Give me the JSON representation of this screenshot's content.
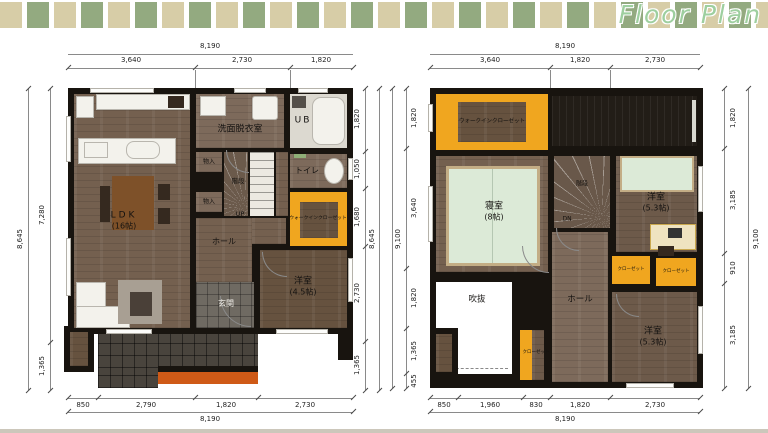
{
  "header": {
    "title": "Floor Plan"
  },
  "colors": {
    "band_beige": "#d7cda7",
    "band_green": "#93aa80",
    "title_green": "#9ecf9f",
    "wall_black": "#18140f",
    "floor_wood": "#74604f",
    "closet_orange": "#f0a61f",
    "step_orange": "#cf5a17",
    "bed_green": "#dcead7",
    "porch_tile": "#49443d"
  },
  "plan1": {
    "top": {
      "total": "8,190",
      "segments": [
        "3,640",
        "2,730",
        "1,820"
      ]
    },
    "left": {
      "total": "8,645",
      "segments": [
        "7,280",
        "1,365"
      ]
    },
    "right": {
      "total": "8,645",
      "segments": [
        "1,820",
        "1,050",
        "1,680",
        "2,730",
        "1,365"
      ]
    },
    "bottom": {
      "total": "8,190",
      "segments": [
        "850",
        "2,790",
        "1,820",
        "2,730"
      ]
    },
    "rooms": {
      "ldk": "LDK",
      "ldk_size": "(16帖)",
      "washroom": "洗面脱衣室",
      "bath": "UB",
      "toilet": "トイレ",
      "storage1": "物入",
      "storage2": "物入",
      "stairs": "階段",
      "up": "UP",
      "wic": "ウォークインクローゼット",
      "hall": "ホール",
      "bedroom": "洋室",
      "bedroom_size": "(4.5帖)",
      "entrance": "玄関"
    }
  },
  "plan2": {
    "top": {
      "total": "8,190",
      "segments": [
        "3,640",
        "1,820",
        "2,730"
      ]
    },
    "left": {
      "total": "9,100",
      "segments": [
        "1,820",
        "3,640",
        "1,820",
        "1,365",
        "455"
      ]
    },
    "right": {
      "total": "9,100",
      "segments": [
        "1,820",
        "3,185",
        "910",
        "3,185"
      ]
    },
    "bottom": {
      "total": "8,190",
      "segments": [
        "850",
        "1,960",
        "830",
        "1,820",
        "2,730"
      ]
    },
    "rooms": {
      "wic": "ウォークインクローゼット",
      "master": "寝室",
      "master_size": "(8帖)",
      "stairs": "階段",
      "dn": "DN",
      "bedroom2": "洋室",
      "bedroom2_size": "(5.3帖)",
      "closet1": "クローゼット",
      "closet2": "クローゼット",
      "closet3": "クローゼット",
      "void": "吹抜",
      "hall": "ホール",
      "bedroom3": "洋室",
      "bedroom3_size": "(5.3帖)"
    }
  }
}
